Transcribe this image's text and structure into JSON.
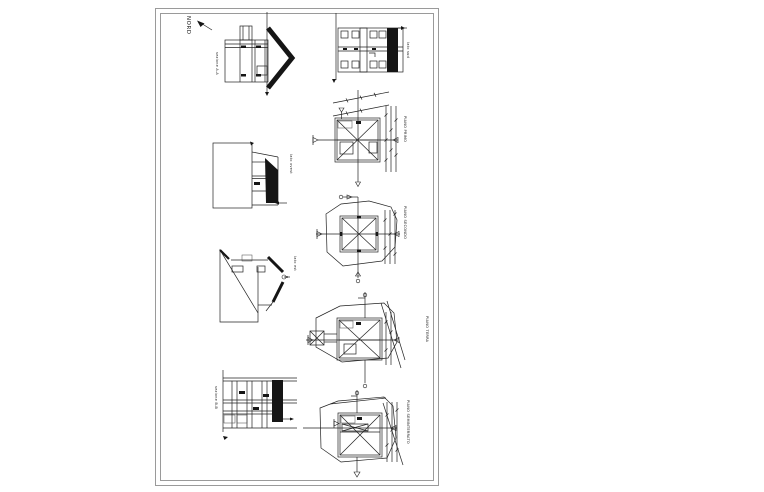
{
  "page": {
    "background": "#ffffff",
    "paper_color": "#ffffff",
    "border_color": "#9a9a9a",
    "ink_color": "#222222"
  },
  "sheet": {
    "north_label": "NORD",
    "drawings": [
      {
        "id": "section-aa",
        "label": "sezione A-A"
      },
      {
        "id": "elevation-sud",
        "label": "lato sud"
      },
      {
        "id": "plan-primo",
        "label": "PIANO PRIMO"
      },
      {
        "id": "elevation-ovest",
        "label": "lato ovest"
      },
      {
        "id": "plan-secondo",
        "label": "PIANO SECONDO"
      },
      {
        "id": "elevation-est",
        "label": "lato est"
      },
      {
        "id": "plan-terra",
        "label": "PIANO TERRA"
      },
      {
        "id": "section-bb",
        "label": "sezione B-B"
      },
      {
        "id": "plan-seminterrato",
        "label": "PIANO SEMINTERRATO"
      }
    ]
  }
}
